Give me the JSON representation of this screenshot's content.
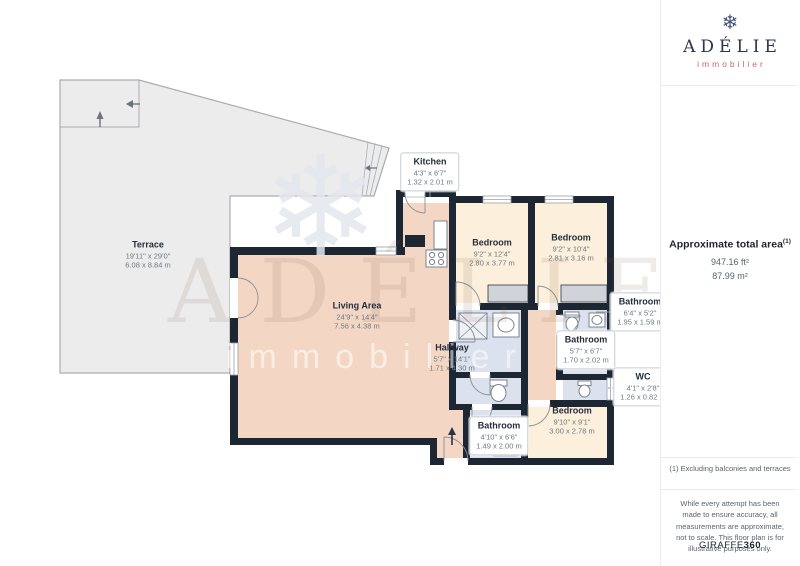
{
  "branding": {
    "name": "ADÉLIE",
    "sub": "immobilier",
    "snowflake_icon": "❄"
  },
  "sidebar": {
    "area_title": "Approximate total area",
    "area_sup": "(1)",
    "area_ft": "947.16 ft²",
    "area_m": "87.99 m²",
    "footnote": "(1) Excluding balconies and terraces",
    "disclaimer": "While every attempt has been made to ensure accuracy, all measurements are approximate, not to scale. This floor plan is for illustrative purposes only.",
    "provider": "GIRAFFE",
    "provider_suffix": "360"
  },
  "watermark": {
    "line1": "ADÉLIE",
    "line2": "immobilier",
    "snowflake": "❄"
  },
  "rooms": {
    "terrace": {
      "name": "Terrace",
      "ft": "19'11\" x 29'0\"",
      "m": "6.08 x 8.84 m"
    },
    "kitchen": {
      "name": "Kitchen",
      "ft": "4'3\" x 6'7\"",
      "m": "1.32 x 2.01 m"
    },
    "living": {
      "name": "Living Area",
      "ft": "24'9\" x 14'4\"",
      "m": "7.56 x 4.38 m"
    },
    "hallway": {
      "name": "Hallway",
      "ft": "5'7\" x 14'1\"",
      "m": "1.71 x 4.30 m"
    },
    "bedroom1": {
      "name": "Bedroom",
      "ft": "9'2\" x 12'4\"",
      "m": "2.80 x 3.77 m"
    },
    "bedroom2": {
      "name": "Bedroom",
      "ft": "9'2\" x 10'4\"",
      "m": "2.81 x 3.16 m"
    },
    "bedroom3": {
      "name": "Bedroom",
      "ft": "9'10\" x 9'1\"",
      "m": "3.00 x 2.78 m"
    },
    "bathroom_top": {
      "name": "Bathroom",
      "ft": "6'4\" x 5'2\"",
      "m": "1.95 x 1.59 m"
    },
    "bathroom_mid": {
      "name": "Bathroom",
      "ft": "5'7\" x 6'7\"",
      "m": "1.70 x 2.02 m"
    },
    "bathroom_bottom": {
      "name": "Bathroom",
      "ft": "4'10\" x 6'6\"",
      "m": "1.49 x 2.00 m"
    },
    "wc": {
      "name": "WC",
      "ft": "4'1\" x 2'8\"",
      "m": "1.26 x 0.82 m"
    }
  },
  "colors": {
    "wall": "#1d2733",
    "floor_living": "#f3d7c4",
    "floor_bedroom": "#fcefdb",
    "floor_bathroom": "#dbe1ed",
    "terrace": "#ececec",
    "closet": "#cfd4da",
    "logo_navy": "#2d3550",
    "logo_red": "#c9666b"
  }
}
